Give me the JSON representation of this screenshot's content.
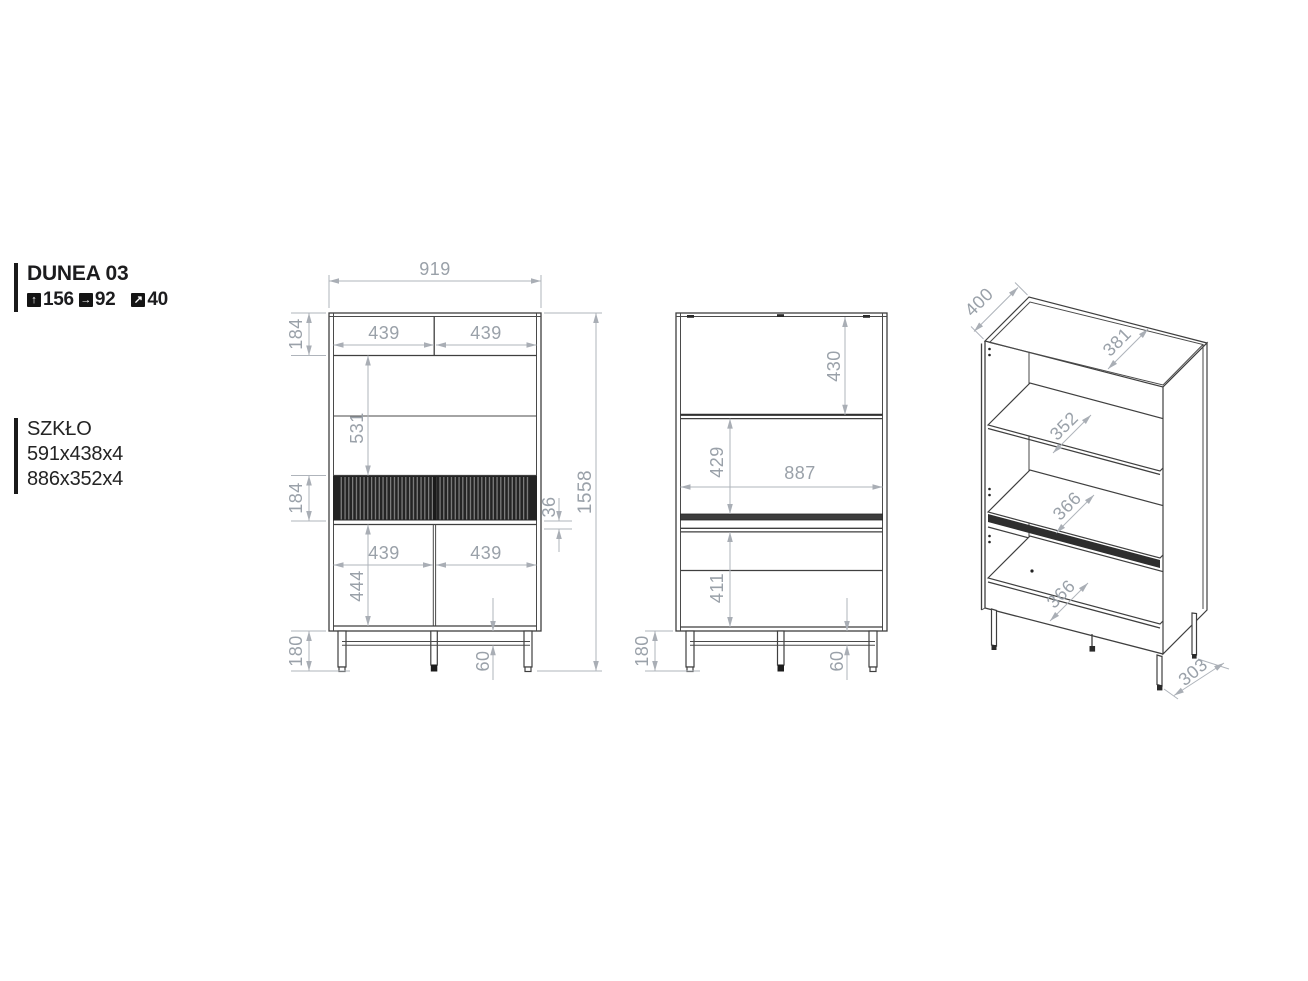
{
  "product": {
    "name": "DUNEA 03",
    "specs": [
      {
        "icon": "height-arrow-icon",
        "glyph": "↑",
        "value": "156"
      },
      {
        "icon": "width-arrow-icon",
        "glyph": "→",
        "value": "92"
      },
      {
        "icon": "depth-arrow-icon",
        "glyph": "↗",
        "value": "40"
      }
    ]
  },
  "glass": {
    "label": "SZKŁO",
    "sizes": [
      "591x438x4",
      "886x352x4"
    ]
  },
  "front_view_dims": {
    "overall_width": "919",
    "overall_height": "1558",
    "top_section_height": "184",
    "top_left_door_width": "439",
    "top_right_door_width": "439",
    "display_section_height": "531",
    "drawer_front_height": "184",
    "rail_gap": "36",
    "bottom_left_door_width": "439",
    "bottom_right_door_width": "439",
    "bottom_door_height": "444",
    "leg_height": "180",
    "stretcher_offset": "60"
  },
  "inside_view_dims": {
    "top_compartment_height": "430",
    "shelf_compartment_height": "429",
    "internal_width": "887",
    "drawer_compartment_height": "411",
    "leg_height": "180",
    "stretcher_offset": "60"
  },
  "iso_view_dims": {
    "depth": "400",
    "top_internal_depth": "381",
    "shelf_depth": "352",
    "middle_shelf_depth": "366",
    "bottom_shelf_depth": "366",
    "leg_span_depth": "303"
  },
  "colors": {
    "dimension_text": "#9aa1a9",
    "dimension_line": "#afb4bb",
    "drawing_line": "#3f3f3f",
    "accent_black": "#1a1a1a"
  }
}
